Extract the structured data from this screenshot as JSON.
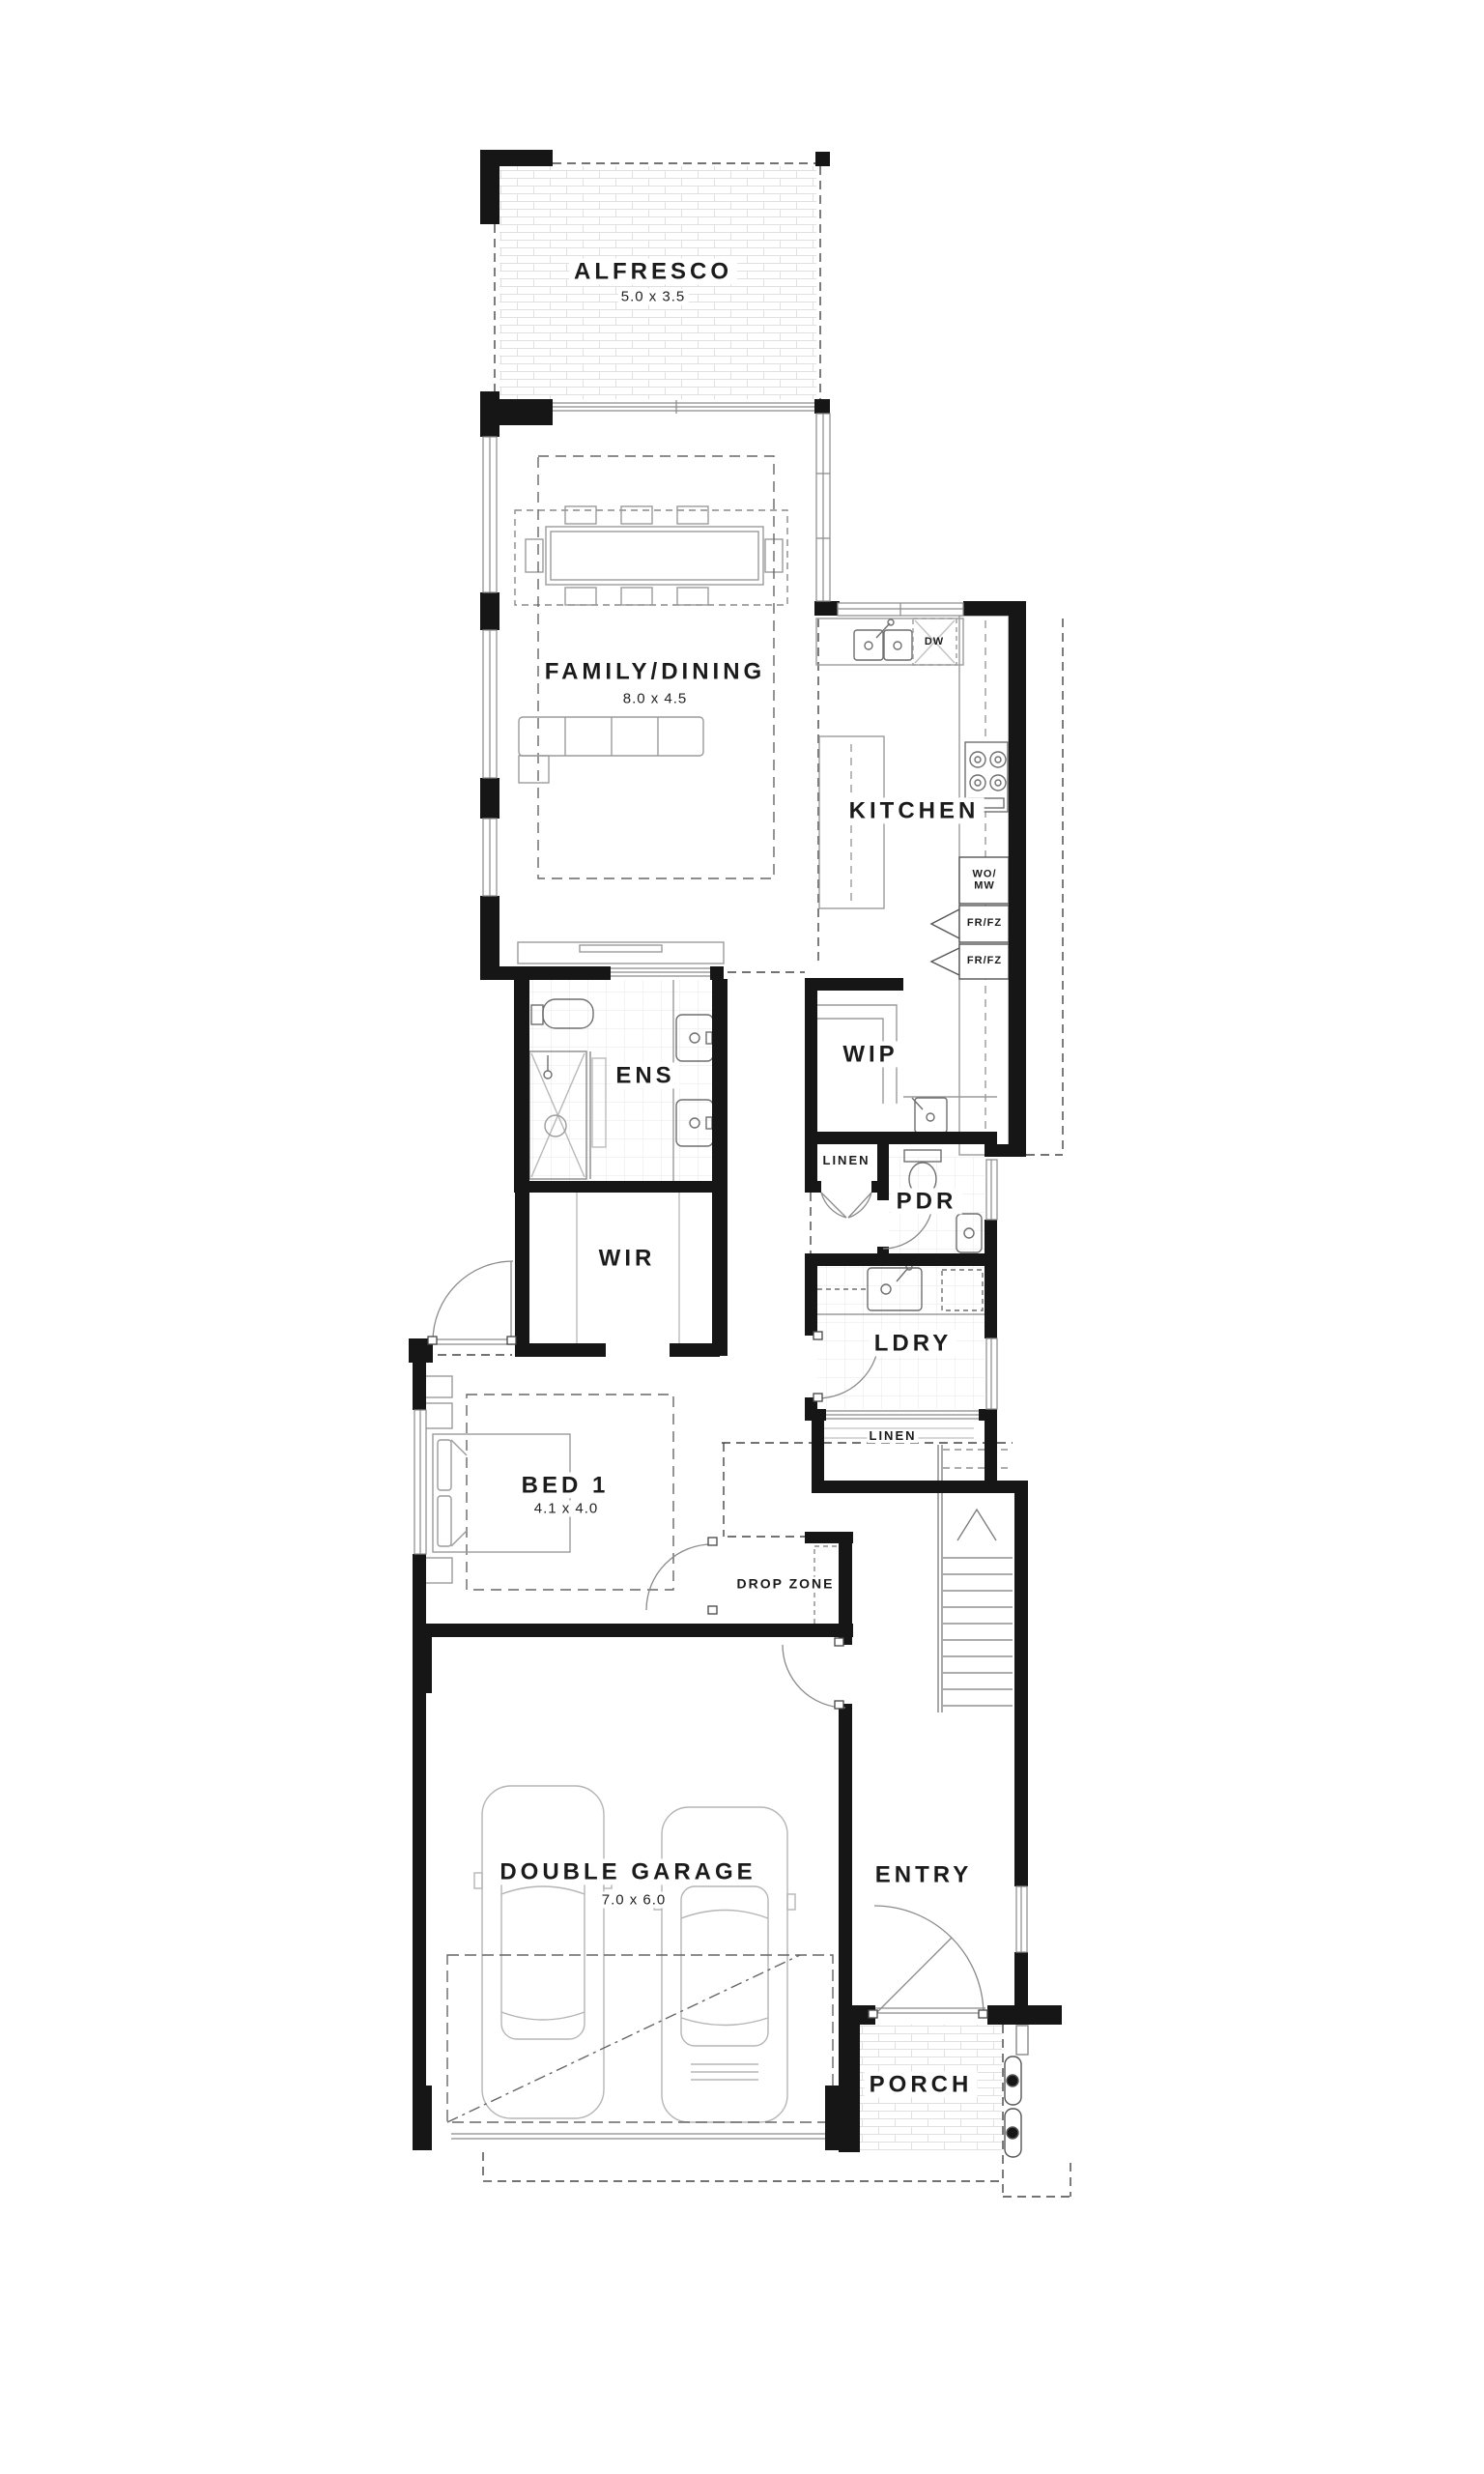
{
  "rooms": {
    "alfresco": {
      "label": "ALFRESCO",
      "dims": "5.0 x 3.5"
    },
    "family_dining": {
      "label": "FAMILY/DINING",
      "dims": "8.0 x 4.5"
    },
    "kitchen": {
      "label": "KITCHEN"
    },
    "ens": {
      "label": "ENS"
    },
    "wip": {
      "label": "WIP"
    },
    "linen_upper": {
      "label": "LINEN"
    },
    "pdr": {
      "label": "PDR"
    },
    "wir": {
      "label": "WIR"
    },
    "ldry": {
      "label": "LDRY"
    },
    "linen_lower": {
      "label": "LINEN"
    },
    "bed1": {
      "label": "BED 1",
      "dims": "4.1 x 4.0"
    },
    "drop_zone": {
      "label": "DROP ZONE"
    },
    "garage": {
      "label": "DOUBLE GARAGE",
      "dims": "7.0 x 6.0"
    },
    "entry": {
      "label": "ENTRY"
    },
    "porch": {
      "label": "PORCH"
    }
  },
  "appliances": {
    "dishwasher": "DW",
    "wall_oven_microwave_line1": "WO/",
    "wall_oven_microwave_line2": "MW",
    "fridge_freezer_1": "FR/FZ",
    "fridge_freezer_2": "FR/FZ"
  },
  "colors": {
    "wall": "#161616",
    "paper": "#ffffff",
    "fixture": "#9b9b9b"
  }
}
